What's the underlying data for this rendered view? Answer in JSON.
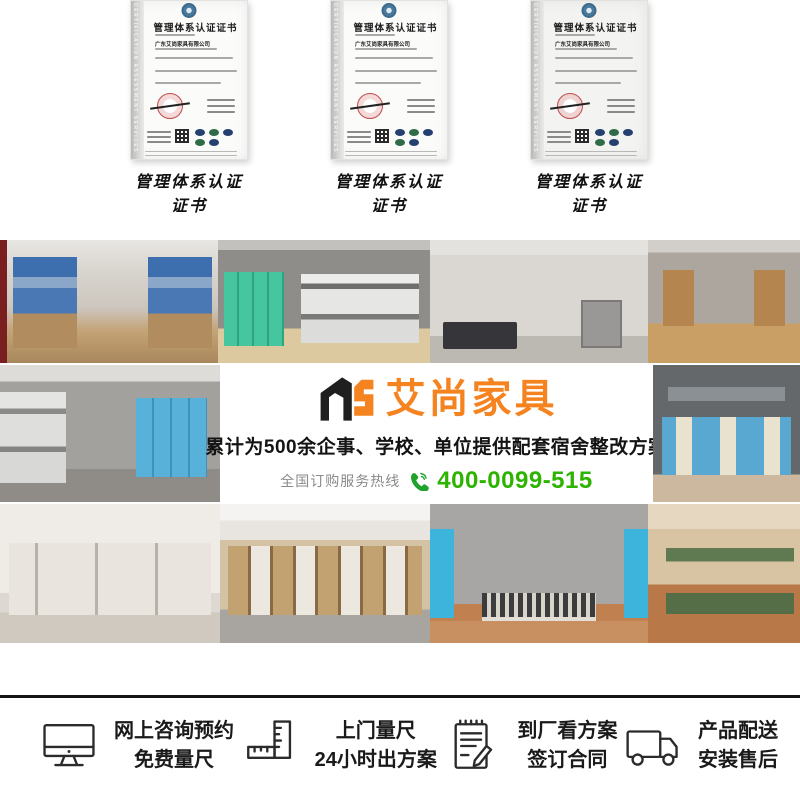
{
  "certificates": {
    "band_text": "CERTIFICATION ASSESSMENT SERVICES",
    "title": "管理体系认证证书",
    "company": "广东艾尚家具有限公司",
    "items": [
      {
        "caption": "管理体系认证证书"
      },
      {
        "caption": "管理体系认证证书"
      },
      {
        "caption": "管理体系认证证书"
      }
    ]
  },
  "banner": {
    "logo_monogram": "AS",
    "logo_name": "艾尚家具",
    "tagline": "累计为500余企事、学校、单位提供配套宿舍整改方案",
    "hotline_label": "全国订购服务热线",
    "hotline_number": "400-0099-515",
    "colors": {
      "brand_orange": "#f5831f",
      "hotline_green": "#2db400",
      "logo_black": "#1f1f1f"
    }
  },
  "gallery": {
    "photos": [
      {
        "name": "blue-bunk-dorm-room"
      },
      {
        "name": "green-lockers-grey-bunk-room"
      },
      {
        "name": "single-bed-desk-cabinet-room"
      },
      {
        "name": "wooden-cabinet-dorm-corridor"
      },
      {
        "name": "grey-dorm-blue-cabinets"
      },
      {
        "name": "loft-beds-blue-desk-units"
      },
      {
        "name": "white-triple-bunk-room"
      },
      {
        "name": "loft-bed-wardrobe-desk-combo"
      },
      {
        "name": "blue-wardrobe-metal-beds-room"
      },
      {
        "name": "green-steel-bunk-beds"
      }
    ]
  },
  "services": {
    "items": [
      {
        "icon": "monitor-icon",
        "line1": "网上咨询预约",
        "line2": "免费量尺"
      },
      {
        "icon": "ruler-icon",
        "line1": "上门量尺",
        "line2": "24小时出方案"
      },
      {
        "icon": "contract-icon",
        "line1": "到厂看方案",
        "line2": "签订合同"
      },
      {
        "icon": "truck-icon",
        "line1": "产品配送",
        "line2": "安装售后"
      }
    ]
  }
}
